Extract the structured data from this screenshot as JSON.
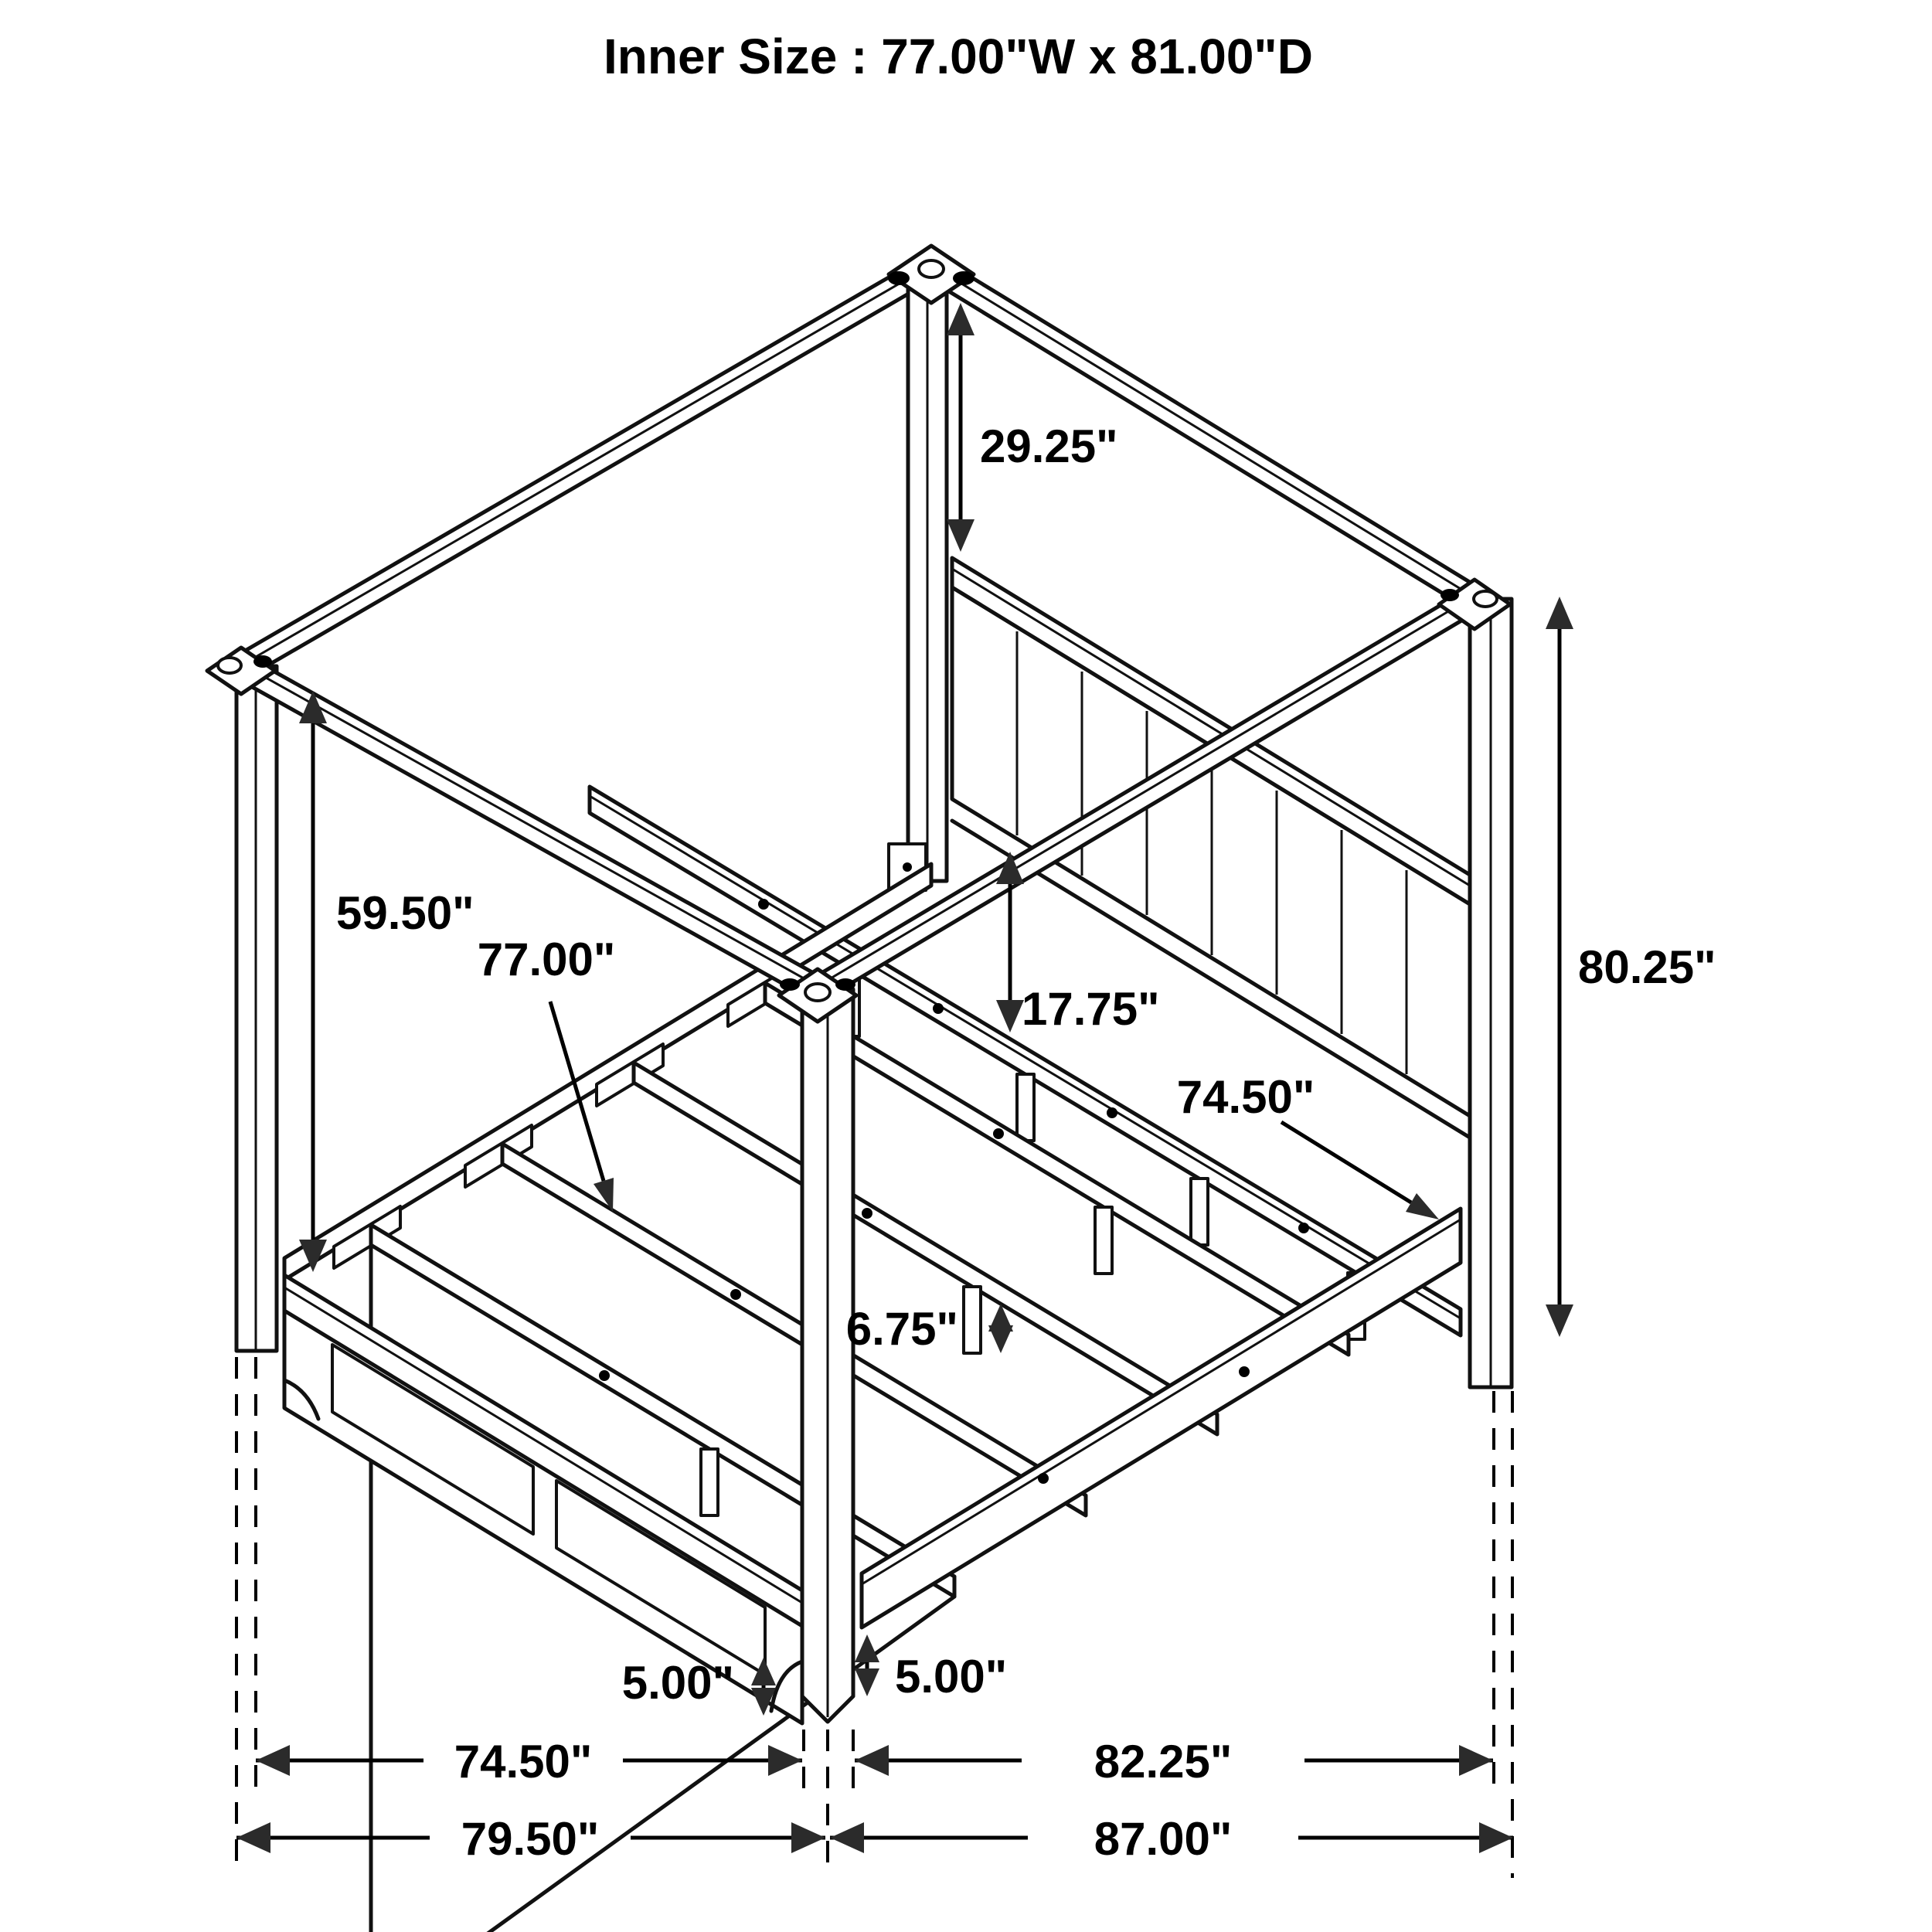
{
  "title": "Inner Size : 77.00\"W x 81.00\"D",
  "dimensions": {
    "post_above_headboard": "29.25\"",
    "under_canopy_height": "59.50\"",
    "slat_length": "77.00\"",
    "headboard_to_rail": "17.75\"",
    "side_rail_length": "74.50\"",
    "overall_height": "80.25\"",
    "slat_leg_height": "6.75\"",
    "foot_clearance_left": "5.00\"",
    "foot_clearance_right": "5.00\"",
    "inner_width_bottom": "74.50\"",
    "inner_depth_bottom": "82.25\"",
    "overall_width": "79.50\"",
    "overall_depth": "87.00\""
  },
  "colors": {
    "line": "#111111",
    "background": "#ffffff",
    "arrow": "#2b2b2b"
  }
}
